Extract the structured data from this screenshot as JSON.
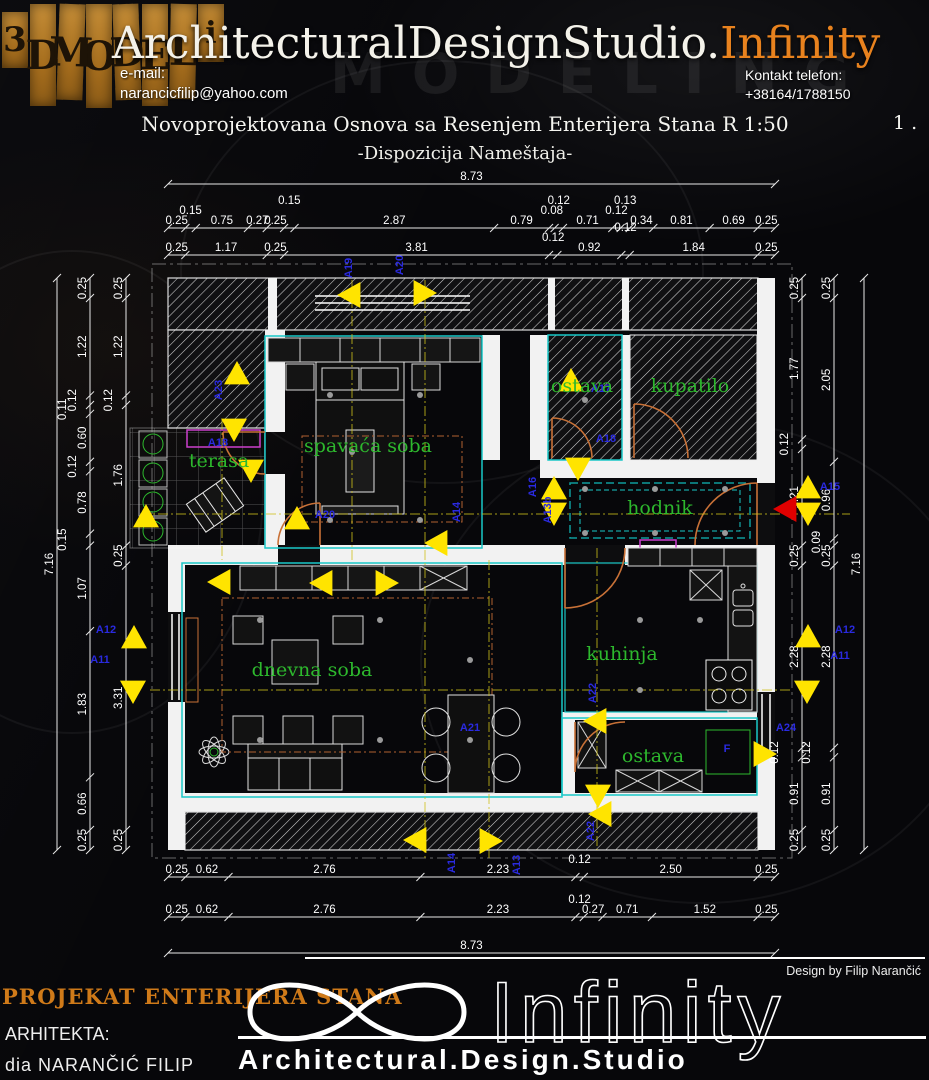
{
  "header": {
    "logo_letters": [
      "3",
      "D",
      "M",
      "O",
      "D",
      "E",
      "L",
      "i"
    ],
    "studio_name_white": "ArchitecturalDesignStudio.",
    "studio_name_orange": "Infinity",
    "email_label": "e-mail:",
    "email": "narancicfilip@yahoo.com",
    "phone_label": "Kontakt telefon:",
    "phone": "+38164/1788150",
    "watermark": "MODELING"
  },
  "drawing": {
    "title": "Novoprojektovana Osnova sa Resenjem Enterijera Stana R 1:50",
    "subtitle": "-Dispozicija Nameštaja-",
    "sheet_number": "1 ."
  },
  "colors": {
    "accent_orange": "#e8821e",
    "marker_blue": "#2a2ae0",
    "room_green": "#2db82d",
    "triangle_yellow": "#ffe400",
    "entrance_red": "#e00000",
    "wall_white": "#f2f2f2",
    "outline_cyan": "#19c8c8",
    "door_orange": "#c87137"
  },
  "plan": {
    "rooms": [
      {
        "name": "terasa",
        "x": 219,
        "y": 467
      },
      {
        "name": "spavaća soba",
        "x": 368,
        "y": 452
      },
      {
        "name": "ostava",
        "x": 582,
        "y": 392
      },
      {
        "name": "kupatilo",
        "x": 690,
        "y": 392
      },
      {
        "name": "hodnik",
        "x": 660,
        "y": 514
      },
      {
        "name": "dnevna soba",
        "x": 312,
        "y": 676
      },
      {
        "name": "kuhinja",
        "x": 622,
        "y": 660
      },
      {
        "name": "ostava",
        "x": 653,
        "y": 762
      }
    ],
    "markers": [
      {
        "label": "A19",
        "x": 352,
        "y": 268,
        "v": true
      },
      {
        "label": "A20",
        "x": 403,
        "y": 265,
        "v": true
      },
      {
        "label": "A23",
        "x": 222,
        "y": 390,
        "v": true
      },
      {
        "label": "A18",
        "x": 218,
        "y": 446
      },
      {
        "label": "A17",
        "x": 601,
        "y": 392
      },
      {
        "label": "A18",
        "x": 606,
        "y": 442
      },
      {
        "label": "A16",
        "x": 536,
        "y": 487,
        "v": true
      },
      {
        "label": "A13b",
        "x": 551,
        "y": 510,
        "v": true
      },
      {
        "label": "A14",
        "x": 460,
        "y": 512,
        "v": true
      },
      {
        "label": "A20",
        "x": 325,
        "y": 518
      },
      {
        "label": "A15",
        "x": 830,
        "y": 490
      },
      {
        "label": "A12",
        "x": 106,
        "y": 633
      },
      {
        "label": "A11",
        "x": 100,
        "y": 663
      },
      {
        "label": "A12",
        "x": 845,
        "y": 633
      },
      {
        "label": "A11",
        "x": 840,
        "y": 659
      },
      {
        "label": "A24",
        "x": 786,
        "y": 731
      },
      {
        "label": "A21",
        "x": 470,
        "y": 731
      },
      {
        "label": "A22",
        "x": 596,
        "y": 693,
        "v": true
      },
      {
        "label": "A22",
        "x": 594,
        "y": 831,
        "v": true
      },
      {
        "label": "A14",
        "x": 455,
        "y": 863,
        "v": true
      },
      {
        "label": "A13",
        "x": 520,
        "y": 865,
        "v": true
      },
      {
        "label": "F",
        "x": 727,
        "y": 752
      }
    ],
    "triangles": [
      {
        "x": 350,
        "y": 295,
        "d": "left"
      },
      {
        "x": 424,
        "y": 293,
        "d": "right"
      },
      {
        "x": 237,
        "y": 374,
        "d": "up"
      },
      {
        "x": 234,
        "y": 429,
        "d": "down"
      },
      {
        "x": 251,
        "y": 470,
        "d": "down"
      },
      {
        "x": 146,
        "y": 517,
        "d": "up"
      },
      {
        "x": 297,
        "y": 519,
        "d": "up"
      },
      {
        "x": 437,
        "y": 543,
        "d": "left"
      },
      {
        "x": 571,
        "y": 381,
        "d": "up"
      },
      {
        "x": 578,
        "y": 468,
        "d": "down"
      },
      {
        "x": 554,
        "y": 489,
        "d": "up"
      },
      {
        "x": 554,
        "y": 513,
        "d": "down"
      },
      {
        "x": 808,
        "y": 488,
        "d": "up"
      },
      {
        "x": 808,
        "y": 513,
        "d": "down"
      },
      {
        "x": 786,
        "y": 509,
        "d": "left",
        "c": "#e00000"
      },
      {
        "x": 220,
        "y": 582,
        "d": "left"
      },
      {
        "x": 322,
        "y": 583,
        "d": "left"
      },
      {
        "x": 386,
        "y": 583,
        "d": "right"
      },
      {
        "x": 134,
        "y": 638,
        "d": "up"
      },
      {
        "x": 133,
        "y": 691,
        "d": "down"
      },
      {
        "x": 808,
        "y": 637,
        "d": "up"
      },
      {
        "x": 807,
        "y": 691,
        "d": "down"
      },
      {
        "x": 596,
        "y": 721,
        "d": "left"
      },
      {
        "x": 764,
        "y": 754,
        "d": "right"
      },
      {
        "x": 598,
        "y": 795,
        "d": "down"
      },
      {
        "x": 601,
        "y": 814,
        "d": "left"
      },
      {
        "x": 416,
        "y": 840,
        "d": "left"
      },
      {
        "x": 490,
        "y": 841,
        "d": "right"
      }
    ],
    "dim_chains": [
      {
        "id": "top-overall",
        "orient": "h",
        "x": 168,
        "y": 184,
        "len": 607,
        "values": [
          "8.73"
        ]
      },
      {
        "id": "top-row-a",
        "orient": "h",
        "x": 168,
        "y": 228,
        "len": 607,
        "values": [
          "0.25",
          "0.15",
          "0.75",
          "0.27",
          "0.25",
          "0.15",
          "2.87",
          "0.79",
          "0.08",
          "0.12",
          "0.71",
          "0.12",
          "0.13",
          "0.34",
          "0.81",
          "0.69",
          "0.25"
        ]
      },
      {
        "id": "top-row-b",
        "orient": "h",
        "x": 168,
        "y": 255,
        "len": 607,
        "values": [
          "0.25",
          "1.17",
          "0.25",
          "3.81",
          "0.12",
          "0.92",
          "0.12",
          "1.84",
          "0.25"
        ]
      },
      {
        "id": "bottom-row-a",
        "orient": "h",
        "x": 168,
        "y": 877,
        "len": 607,
        "values": [
          "0.25",
          "0.62",
          "2.76",
          "2.23",
          "0.12",
          "2.50",
          "0.25"
        ]
      },
      {
        "id": "bottom-row-b",
        "orient": "h",
        "x": 168,
        "y": 917,
        "len": 607,
        "values": [
          "0.25",
          "0.62",
          "2.76",
          "2.23",
          "0.12",
          "0.27",
          "0.71",
          "1.52",
          "0.25"
        ]
      },
      {
        "id": "bottom-overall",
        "orient": "h",
        "x": 168,
        "y": 953,
        "len": 607,
        "values": [
          "8.73"
        ]
      },
      {
        "id": "left-overall",
        "orient": "v",
        "x": 57,
        "y": 278,
        "len": 572,
        "values": [
          "7.16"
        ]
      },
      {
        "id": "left-outer",
        "orient": "v",
        "x": 90,
        "y": 278,
        "len": 572,
        "values": [
          "0.25",
          "1.22",
          "0.12",
          "0.11",
          "0.60",
          "0.12",
          "0.78",
          "0.15",
          "1.07",
          "1.83",
          "0.66",
          "0.25"
        ]
      },
      {
        "id": "left-inner",
        "orient": "v",
        "x": 126,
        "y": 278,
        "len": 572,
        "values": [
          "0.25",
          "1.22",
          "0.12",
          "1.76",
          "0.25",
          "3.31",
          "0.25"
        ]
      },
      {
        "id": "right-inner",
        "orient": "v",
        "x": 802,
        "y": 278,
        "len": 572,
        "values": [
          "0.25",
          "1.77",
          "0.12",
          "1.21",
          "0.25",
          "2.28",
          "0.12",
          "0.91",
          "0.25"
        ]
      },
      {
        "id": "right-mid",
        "orient": "v",
        "x": 834,
        "y": 278,
        "len": 572,
        "values": [
          "0.25",
          "2.05",
          "0.96",
          "0.09",
          "0.25",
          "2.28",
          "0.12",
          "0.91",
          "0.25"
        ]
      },
      {
        "id": "right-overall",
        "orient": "v",
        "x": 864,
        "y": 278,
        "len": 572,
        "values": [
          "7.16"
        ]
      }
    ]
  },
  "footer": {
    "design_by": "Design by Filip Narančić",
    "project_title": "PROJEKAT ENTERIJERA STANA",
    "architect_label": "ARHITEKTA:",
    "architect_name": "dia  NARANČIĆ  FILIP",
    "logo_text": "Infinity",
    "studio_line": "Architectural.Design.Studio"
  }
}
